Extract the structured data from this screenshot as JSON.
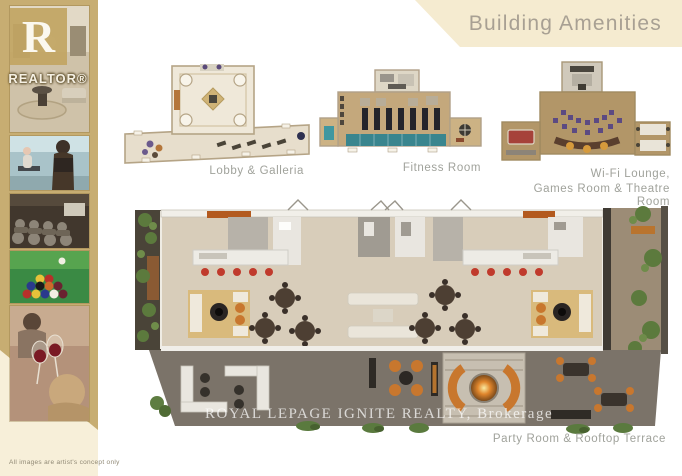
{
  "header": {
    "title": "Building Amenities"
  },
  "sidebar": {
    "logo": {
      "letter": "R",
      "wordmark": "REALTOR®"
    },
    "photos": [
      "lobby-interior",
      "fitness-room",
      "theatre-room",
      "billiards",
      "wine-social"
    ],
    "disclaimer": "All images are artist's concept only"
  },
  "plans": {
    "lobby": {
      "label": "Lobby & Galleria"
    },
    "fitness": {
      "label": "Fitness Room"
    },
    "wifi": {
      "label_line1": "Wi-Fi Lounge,",
      "label_line2": "Games Room & Theatre Room"
    },
    "party": {
      "label": "Party Room & Rooftop Terrace",
      "watermark": "ROYAL LEPAGE IGNITE REALTY,  Brokerage"
    }
  },
  "colors": {
    "sidebar_gold": "#c7ad72",
    "band_cream": "#f5ebd0",
    "title_gray": "#a8a093",
    "label_gray": "#a0a29b",
    "accent_orange": "#c8772e",
    "stool_red": "#c03a2c",
    "pool_teal": "#39858e",
    "theatre_purple": "#5c4a82"
  }
}
